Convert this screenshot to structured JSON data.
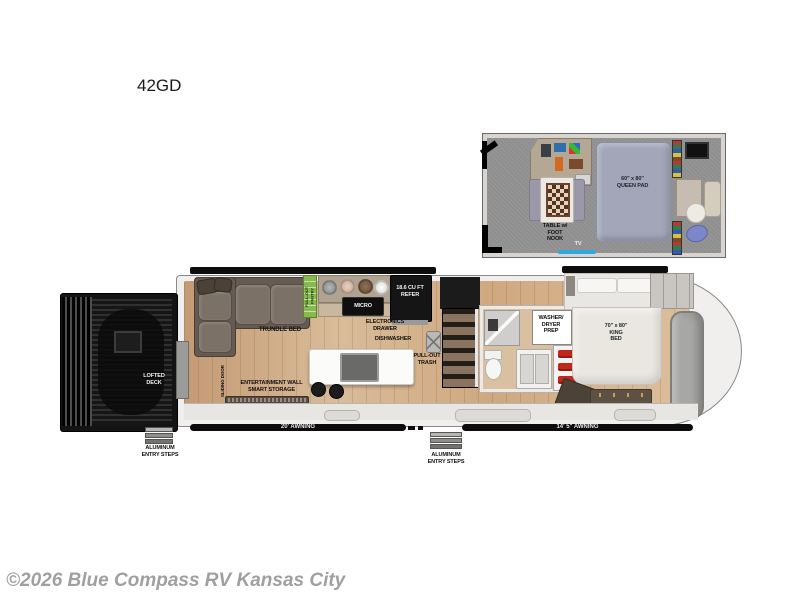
{
  "page": {
    "title": "42GD",
    "watermark": "©2026 Blue Compass RV Kansas City"
  },
  "loft_plan": {
    "table_nook_label": "TABLE w/\nFOOT\nNOOK",
    "queen_pad_label": "60\" x 80\"\nQUEEN PAD",
    "tv_label": "TV"
  },
  "main_plan": {
    "lofted_deck_label": "LOFTED\nDECK",
    "left_entry_steps_label": "ALUMINUM\nENTRY STEPS",
    "center_entry_steps_label": "ALUMINUM\nENTRY STEPS",
    "sliding_door_label": "SLIDING DOOR",
    "trundle_bed_label": "TRUNDLE BED",
    "pantry_label": "PULL-OUT\nPANTRY",
    "micro_label": "MICRO",
    "refer_label": "18.6 CU FT\nREFER",
    "electronics_drawer_label": "ELECTRONICS\nDRAWER",
    "dishwasher_label": "DISHWASHER",
    "pull_out_trash_label": "PULL-OUT\nTRASH",
    "entertainment_wall_label": "ENTERTAINMENT WALL\nSMART STORAGE",
    "washer_dryer_label": "WASHER/\nDRYER\nPREP",
    "king_bed_label": "70\" x 80\"\nKING\nBED",
    "telescoping_tv_label": "TELESCOPING TV",
    "awning_left_label": "20' AWNING",
    "awning_right_label": "14' 5\" AWNING"
  },
  "colors": {
    "wood_floor": "#cfa985",
    "loft_carpet": "#8f8f8f",
    "deck_black": "#141414",
    "awning_black": "#0c0c0c",
    "pantry_green": "#86b94e",
    "tv_blue": "#2fa8e0",
    "queen_pad": "#a2a6b8",
    "watermark_gray": "#a0a0a0"
  }
}
